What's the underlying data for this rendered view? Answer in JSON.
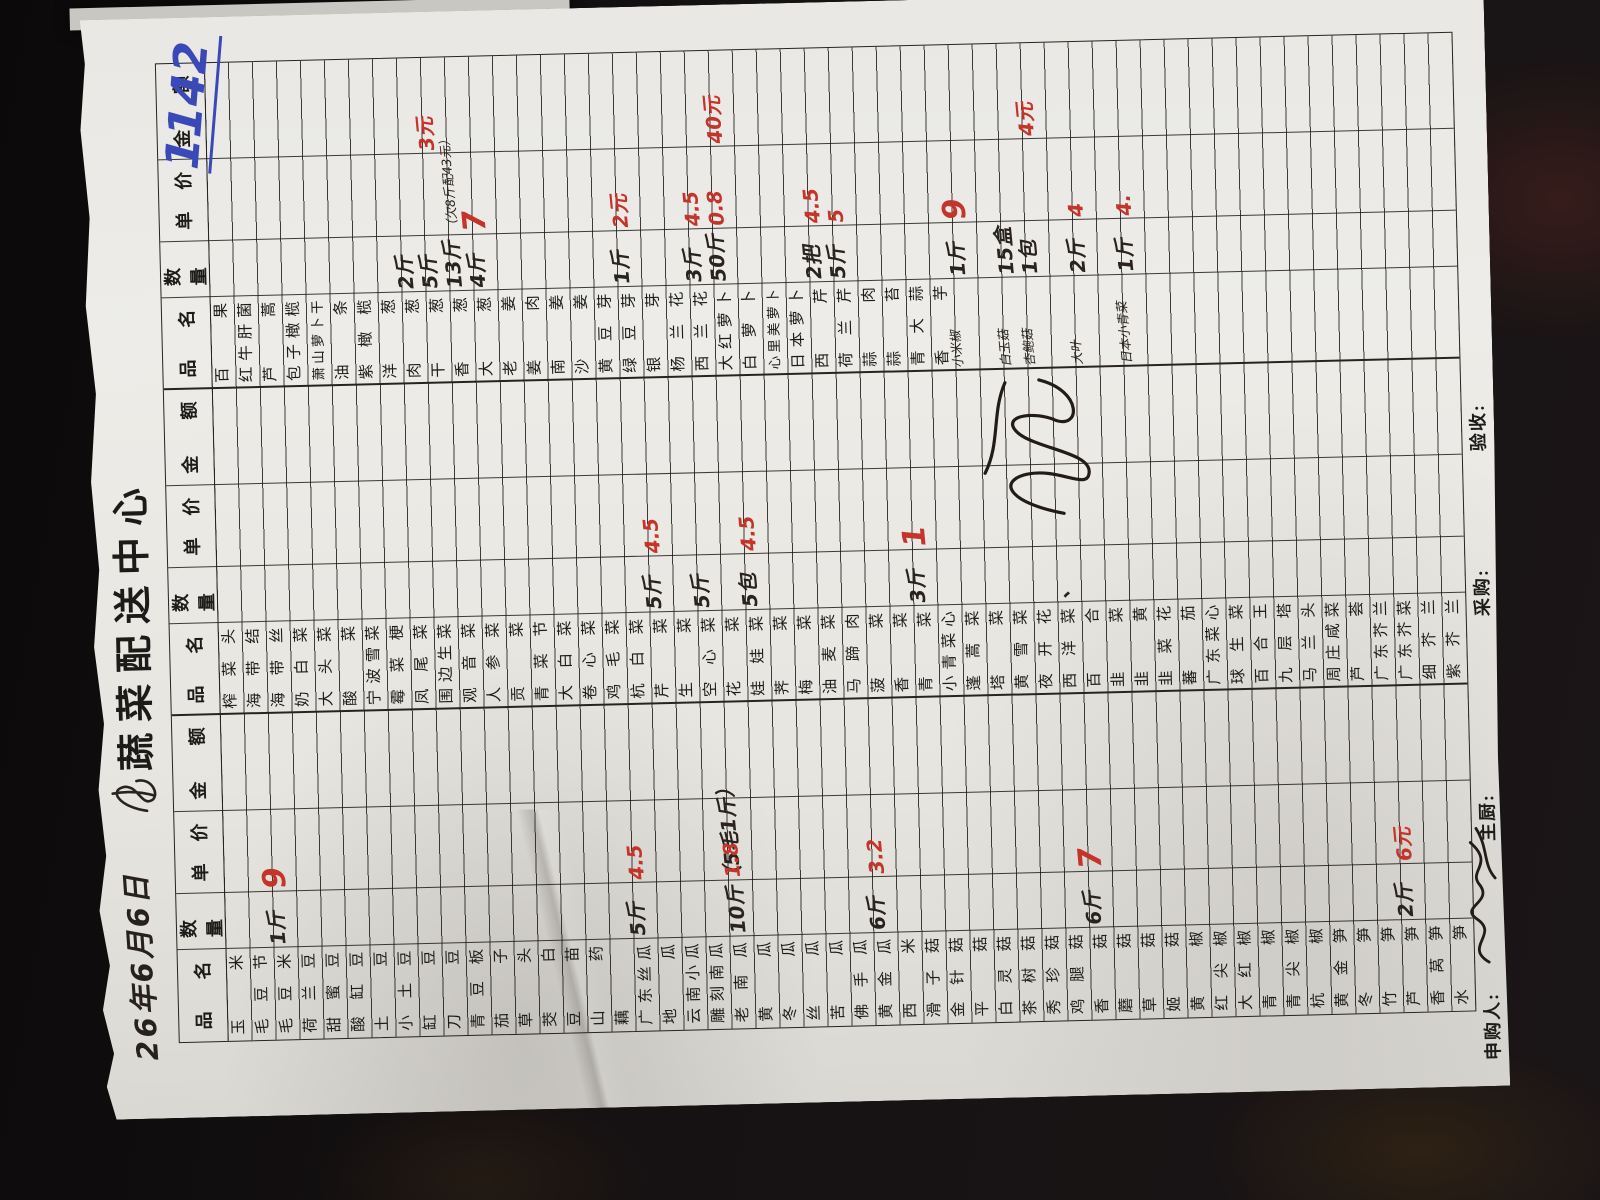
{
  "doc": {
    "date_handwritten": "26年6月6日",
    "title": "蔬菜配送中心",
    "blue_number": "1142",
    "headers": {
      "name": "品名",
      "qty": "数量",
      "price": "单价",
      "amount": "金额"
    },
    "footer": {
      "requester": "申购人:",
      "chef": "主厨:",
      "buyer": "采购:",
      "receiver": "验收:"
    }
  },
  "colors": {
    "red_ink": "#c5342a",
    "black_ink": "#29231f",
    "blue_ink": "#3b49b8",
    "paper": "#e7e5e0"
  },
  "groups": [
    {
      "items": [
        "玉米",
        "毛豆节",
        "毛豆米",
        "荷兰豆",
        "甜蜜豆",
        "酸缸豆",
        "土豆",
        "小土豆",
        "缸豆",
        "刀豆",
        "青豆板",
        "茄子",
        "草头",
        "茭白",
        "豆苗",
        "山药",
        "藕",
        "广东丝瓜",
        "地瓜",
        "云南小瓜",
        "雕刻南瓜",
        "老南瓜",
        "黄瓜",
        "冬瓜",
        "丝瓜",
        "苦瓜",
        "佛手瓜",
        "黄金瓜",
        "西米",
        "滑子菇",
        "金针菇",
        "平菇",
        "白灵菇",
        "茶树菇",
        "秀珍菇",
        "鸡腿菇",
        "香菇",
        "蘑菇",
        "草菇",
        "姬菇",
        "黄椒",
        "红尖椒",
        "大红椒",
        "青椒",
        "青尖椒",
        "杭椒",
        "黄金笋",
        "冬笋",
        "竹笋",
        "芦笋",
        "香莴笋",
        "水笋"
      ]
    },
    {
      "items": [
        "榨菜头",
        "海带结",
        "海带丝",
        "奶白菜",
        "大头菜",
        "酸菜",
        "宁波雪菜",
        "霉菜梗",
        "凤尾菜",
        "围边生菜",
        "观音菜",
        "人参菜",
        "贡菜",
        "青菜节",
        "大白菜",
        "卷心菜",
        "鸡毛菜",
        "杭白菜",
        "芹菜",
        "生菜",
        "空心菜",
        "花菜",
        "娃娃菜",
        "荠菜",
        "梅菜",
        "油麦菜",
        "马蹄肉",
        "菠菜",
        "香菜",
        "青菜",
        "小青菜心",
        "蓬蒿菜",
        "塔菜",
        "黄雪菜",
        "夜开花",
        "西洋菜",
        "百合",
        "韭菜",
        "韭黄",
        "韭菜花",
        "蕃茄",
        "广东菜心",
        "球生菜",
        "百合王",
        "九层塔",
        "马兰头",
        "周庄咸菜",
        "芦荟",
        "广东芥兰",
        "广东芥菜",
        "细芥兰",
        "紫芥兰"
      ]
    },
    {
      "items": [
        "百果",
        "红牛肝菌",
        "芦蒿",
        "包子橄榄",
        "萧山萝卜干",
        "油条",
        "紫橄榄",
        "洋葱",
        "肉葱",
        "干葱",
        "香葱",
        "大葱",
        "老姜",
        "姜肉",
        "南姜",
        "沙姜",
        "黄豆芽",
        "绿豆芽",
        "银芽",
        "杨兰花",
        "西兰花",
        "大红萝卜",
        "白萝卜",
        "心里美萝卜",
        "日本萝卜",
        "西芹",
        "荷兰芹",
        "蒜肉",
        "蒜苔",
        "青大蒜",
        "香芋",
        "",
        "",
        "",
        "",
        "",
        "",
        "",
        "",
        "",
        "",
        "",
        "",
        "",
        "",
        "",
        "",
        "",
        "",
        "",
        "",
        ""
      ]
    }
  ],
  "entries": [
    {
      "g": 0,
      "row": 3,
      "col": "qty",
      "text": "1斤",
      "color": "ink"
    },
    {
      "g": 0,
      "row": 3,
      "col": "price",
      "text": "9",
      "color": "red",
      "size": "lg"
    },
    {
      "g": 0,
      "row": 18,
      "col": "qty",
      "text": "5斤",
      "color": "ink"
    },
    {
      "g": 0,
      "row": 18,
      "col": "price",
      "text": "4.5",
      "color": "red"
    },
    {
      "g": 0,
      "row": 22,
      "col": "qty",
      "text": "10斤（5毛1斤）",
      "color": "ink"
    },
    {
      "g": 0,
      "row": 22,
      "col": "price",
      "text": "1.8",
      "color": "red"
    },
    {
      "g": 0,
      "row": 28,
      "col": "qty",
      "text": "6斤",
      "color": "ink"
    },
    {
      "g": 0,
      "row": 28,
      "col": "price",
      "text": "3.2",
      "color": "red"
    },
    {
      "g": 0,
      "row": 37,
      "col": "qty",
      "text": "6斤",
      "color": "ink"
    },
    {
      "g": 0,
      "row": 37,
      "col": "price",
      "text": "7",
      "color": "red",
      "size": "lg"
    },
    {
      "g": 0,
      "row": 50,
      "col": "qty",
      "text": "2斤",
      "color": "ink"
    },
    {
      "g": 0,
      "row": 50,
      "col": "price",
      "text": "6元",
      "color": "red"
    },
    {
      "g": 1,
      "row": 19,
      "col": "qty",
      "text": "5斤",
      "color": "ink"
    },
    {
      "g": 1,
      "row": 19,
      "col": "price",
      "text": "4.5",
      "color": "red"
    },
    {
      "g": 1,
      "row": 21,
      "col": "qty",
      "text": "5斤",
      "color": "ink"
    },
    {
      "g": 1,
      "row": 23,
      "col": "qty",
      "text": "5包",
      "color": "ink"
    },
    {
      "g": 1,
      "row": 23,
      "col": "price",
      "text": "4.5",
      "color": "red"
    },
    {
      "g": 1,
      "row": 30,
      "col": "qty",
      "text": "3斤",
      "color": "ink"
    },
    {
      "g": 1,
      "row": 30,
      "col": "price",
      "text": "1",
      "color": "red",
      "size": "lg"
    },
    {
      "g": 1,
      "row": 36,
      "col": "qty",
      "text": "、",
      "color": "ink"
    },
    {
      "g": 2,
      "row": 9,
      "col": "qty",
      "text": "2斤",
      "color": "ink"
    },
    {
      "g": 2,
      "row": 10,
      "col": "qty",
      "text": "5斤",
      "color": "ink"
    },
    {
      "g": 2,
      "row": 10,
      "col": "amount",
      "text": "3元",
      "color": "red"
    },
    {
      "g": 2,
      "row": 11,
      "col": "qty",
      "text": "13斤",
      "color": "ink"
    },
    {
      "g": 2,
      "row": 11,
      "col": "price",
      "text": "（欠8斤配43元）",
      "color": "ink",
      "size": "sm"
    },
    {
      "g": 2,
      "row": 12,
      "col": "qty",
      "text": "4斤",
      "color": "ink"
    },
    {
      "g": 2,
      "row": 12,
      "col": "price",
      "text": "7",
      "color": "red",
      "size": "lg"
    },
    {
      "g": 2,
      "row": 18,
      "col": "qty",
      "text": "1斤",
      "color": "ink"
    },
    {
      "g": 2,
      "row": 18,
      "col": "price",
      "text": "2元",
      "color": "red"
    },
    {
      "g": 2,
      "row": 21,
      "col": "qty",
      "text": "3斤",
      "color": "ink"
    },
    {
      "g": 2,
      "row": 21,
      "col": "price",
      "text": "4.5",
      "color": "red"
    },
    {
      "g": 2,
      "row": 22,
      "col": "qty",
      "text": "50斤",
      "color": "ink"
    },
    {
      "g": 2,
      "row": 22,
      "col": "price",
      "text": "0.8",
      "color": "red"
    },
    {
      "g": 2,
      "row": 22,
      "col": "amount",
      "text": "40元",
      "color": "red"
    },
    {
      "g": 2,
      "row": 26,
      "col": "qty",
      "text": "2把",
      "color": "ink"
    },
    {
      "g": 2,
      "row": 26,
      "col": "price",
      "text": "4.5",
      "color": "red"
    },
    {
      "g": 2,
      "row": 27,
      "col": "qty",
      "text": "5斤",
      "color": "ink"
    },
    {
      "g": 2,
      "row": 27,
      "col": "price",
      "text": "5",
      "color": "red"
    },
    {
      "g": 2,
      "row": 32,
      "col": "name",
      "text": "小米椒",
      "color": "ink",
      "size": "sm"
    },
    {
      "g": 2,
      "row": 32,
      "col": "qty",
      "text": "1斤",
      "color": "ink"
    },
    {
      "g": 2,
      "row": 32,
      "col": "price",
      "text": "9",
      "color": "red",
      "size": "lg"
    },
    {
      "g": 2,
      "row": 34,
      "col": "name",
      "text": "白玉菇",
      "color": "ink",
      "size": "sm"
    },
    {
      "g": 2,
      "row": 34,
      "col": "qty",
      "text": "15盒",
      "color": "ink"
    },
    {
      "g": 2,
      "row": 35,
      "col": "name",
      "text": "杏鲍菇",
      "color": "ink",
      "size": "sm"
    },
    {
      "g": 2,
      "row": 35,
      "col": "qty",
      "text": "1包",
      "color": "ink"
    },
    {
      "g": 2,
      "row": 35,
      "col": "amount",
      "text": "4元",
      "color": "red"
    },
    {
      "g": 2,
      "row": 37,
      "col": "name",
      "text": "大叶",
      "color": "ink",
      "size": "sm"
    },
    {
      "g": 2,
      "row": 37,
      "col": "qty",
      "text": "2斤",
      "color": "ink"
    },
    {
      "g": 2,
      "row": 37,
      "col": "price",
      "text": "4",
      "color": "red"
    },
    {
      "g": 2,
      "row": 39,
      "col": "name",
      "text": "日本小青菜",
      "color": "ink",
      "size": "sm"
    },
    {
      "g": 2,
      "row": 39,
      "col": "qty",
      "text": "1斤",
      "color": "ink"
    },
    {
      "g": 2,
      "row": 39,
      "col": "price",
      "text": "4.",
      "color": "red"
    }
  ]
}
